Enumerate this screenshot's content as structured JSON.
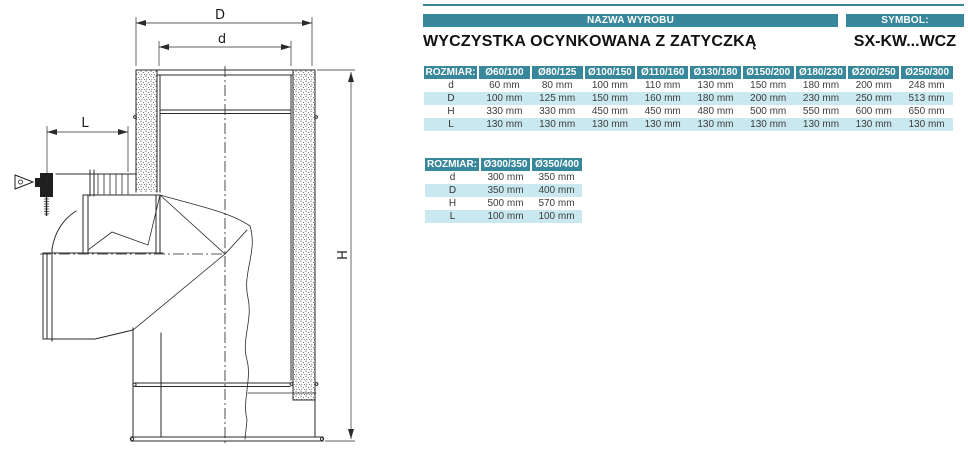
{
  "header": {
    "name_label": "NAZWA WYROBU",
    "symbol_label": "SYMBOL:",
    "product_name": "WYCZYSTKA OCYNKOWANA Z ZATYCZKĄ",
    "symbol_value": "SX-KW...WCZ"
  },
  "colors": {
    "teal": "#38879a",
    "light_blue": "#c9e8f0"
  },
  "drawing": {
    "dim_outer_diameter": "D",
    "dim_inner_diameter": "d",
    "dim_branch_length": "L",
    "dim_height": "H"
  },
  "tables": [
    {
      "size_label": "ROZMIAR:",
      "columns": [
        "Ø60/100",
        "Ø80/125",
        "Ø100/150",
        "Ø110/160",
        "Ø130/180",
        "Ø150/200",
        "Ø180/230",
        "Ø200/250",
        "Ø250/300"
      ],
      "rows": [
        {
          "label": "d",
          "values": [
            "60 mm",
            "80 mm",
            "100 mm",
            "110 mm",
            "130 mm",
            "150 mm",
            "180 mm",
            "200 mm",
            "248 mm"
          ]
        },
        {
          "label": "D",
          "values": [
            "100 mm",
            "125 mm",
            "150 mm",
            "160 mm",
            "180 mm",
            "200 mm",
            "230 mm",
            "250 mm",
            "513 mm"
          ]
        },
        {
          "label": "H",
          "values": [
            "330 mm",
            "330 mm",
            "450 mm",
            "450 mm",
            "480 mm",
            "500 mm",
            "550 mm",
            "600 mm",
            "650 mm"
          ]
        },
        {
          "label": "L",
          "values": [
            "130 mm",
            "130 mm",
            "130 mm",
            "130 mm",
            "130 mm",
            "130 mm",
            "130 mm",
            "130 mm",
            "130 mm"
          ]
        }
      ]
    },
    {
      "size_label": "ROZMIAR:",
      "columns": [
        "Ø300/350",
        "Ø350/400"
      ],
      "rows": [
        {
          "label": "d",
          "values": [
            "300 mm",
            "350 mm"
          ]
        },
        {
          "label": "D",
          "values": [
            "350 mm",
            "400 mm"
          ]
        },
        {
          "label": "H",
          "values": [
            "500 mm",
            "570 mm"
          ]
        },
        {
          "label": "L",
          "values": [
            "100 mm",
            "100 mm"
          ]
        }
      ]
    }
  ]
}
